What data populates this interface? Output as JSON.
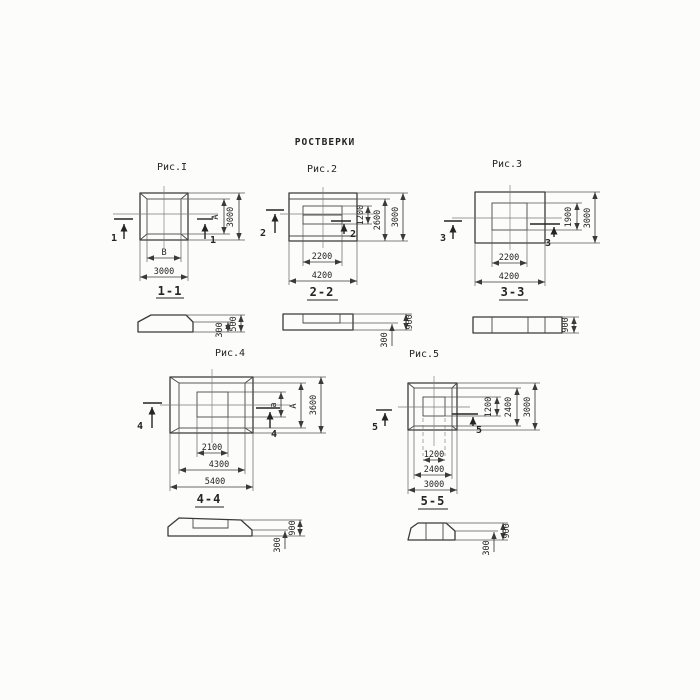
{
  "title": "РОСТВЕРКИ",
  "colors": {
    "ink": "#3a3a3a",
    "paper": "#fcfcfb"
  },
  "fig1": {
    "caption": "Рис.I",
    "mark": "1",
    "section_title": "1-1",
    "dim_inner_height": "А",
    "dim_outer_height": "3000",
    "dim_inner_width": "В",
    "dim_outer_width": "3000",
    "sec_total": "500",
    "sec_bottom": "300"
  },
  "fig2": {
    "caption": "Рис.2",
    "mark": "2",
    "section_title": "2-2",
    "dim_h1": "1200",
    "dim_h2": "2600",
    "dim_h3": "3000",
    "dim_w1": "2200",
    "dim_w2": "4200",
    "sec_total": "900",
    "sec_bottom": "300"
  },
  "fig3": {
    "caption": "Рис.3",
    "mark": "3",
    "section_title": "3-3",
    "dim_h1": "1900",
    "dim_h2": "3000",
    "dim_w1": "2200",
    "dim_w2": "4200",
    "sec_total": "900"
  },
  "fig4": {
    "caption": "Рис.4",
    "mark": "4",
    "section_title": "4-4",
    "dim_h1": "а",
    "dim_h2": "А",
    "dim_h3": "3600",
    "dim_w1": "2100",
    "dim_w2": "4300",
    "dim_w3": "5400",
    "sec_total": "900",
    "sec_bottom": "300"
  },
  "fig5": {
    "caption": "Рис.5",
    "mark": "5",
    "section_title": "5-5",
    "dim_h1": "1200",
    "dim_h2": "2400",
    "dim_h3": "3000",
    "dim_w1": "1200",
    "dim_w2": "2400",
    "dim_w3": "3000",
    "sec_total": "900",
    "sec_bottom": "300"
  }
}
